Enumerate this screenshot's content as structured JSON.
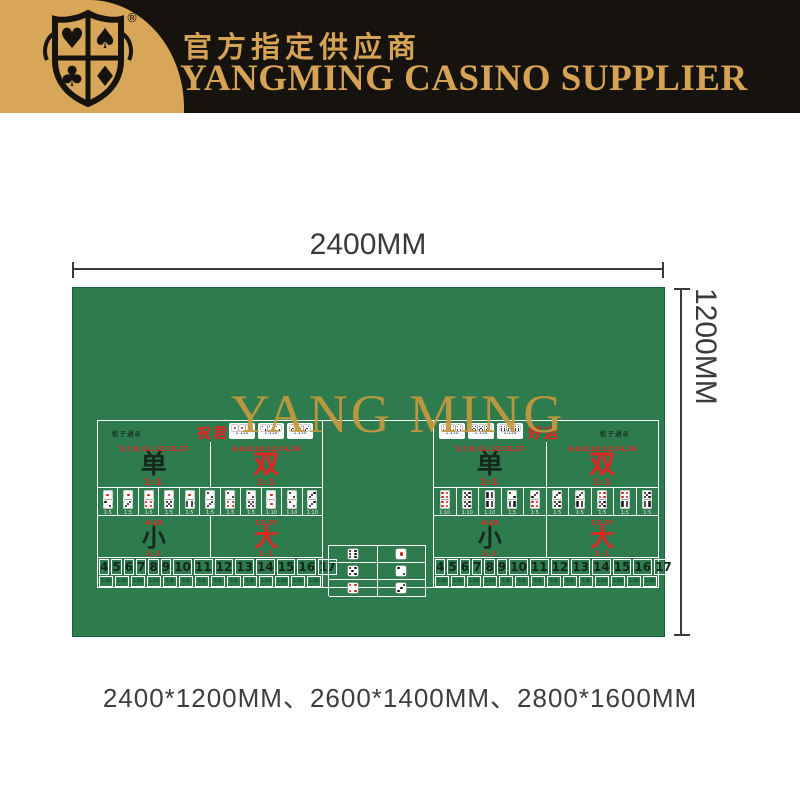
{
  "header": {
    "subtitle_cn": "官方指定供应商",
    "title_en": "YANGMING CASINO SUPPLIER",
    "badge": {
      "suits": [
        "heart",
        "spade",
        "club",
        "diamond"
      ],
      "suits_glyphs": [
        "♥",
        "♠",
        "♣",
        "♦"
      ],
      "registered_mark": "®"
    },
    "colors": {
      "gold": "#D8A658",
      "black": "#16130F"
    }
  },
  "dimensions": {
    "width_label": "2400MM",
    "height_label": "1200MM"
  },
  "table": {
    "felt_color": "#2E7B4E",
    "line_color": "#FFFFFF",
    "watermark": "YANG MING",
    "watermark_color": "#C49A3F",
    "accent_red": "#E42222",
    "center_singles": {
      "rows": [
        [
          6,
          1
        ],
        [
          5,
          2
        ],
        [
          4,
          3
        ]
      ]
    },
    "halves": [
      {
        "side": "left",
        "corner_note": "骰子通杀",
        "luck_label": "祝君",
        "triples": [
          {
            "die": 1,
            "odds": "1:150"
          },
          {
            "die": 2,
            "odds": "1:150"
          },
          {
            "die": 3,
            "odds": "1:150"
          }
        ],
        "odd_even": [
          {
            "numbers": "5,7,9,11,13,15,17",
            "char": "单",
            "odds": "1:1",
            "color": "dark"
          },
          {
            "numbers": "4,6,8,10,12,14,16",
            "char": "双",
            "odds": "1:1",
            "color": "red"
          }
        ],
        "pairs": [
          {
            "dice": [
              1,
              2
            ],
            "odds": "1:5"
          },
          {
            "dice": [
              1,
              3
            ],
            "odds": "1:5"
          },
          {
            "dice": [
              1,
              4
            ],
            "odds": "1:5"
          },
          {
            "dice": [
              1,
              5
            ],
            "odds": "1:5"
          },
          {
            "dice": [
              1,
              6
            ],
            "odds": "1:5"
          },
          {
            "dice": [
              2,
              3
            ],
            "odds": "1:5"
          },
          {
            "dice": [
              2,
              4
            ],
            "odds": "1:5"
          },
          {
            "dice": [
              2,
              5
            ],
            "odds": "1:5"
          },
          {
            "dice": [
              1,
              1
            ],
            "odds": "1:10"
          },
          {
            "dice": [
              2,
              2
            ],
            "odds": "1:10"
          },
          {
            "dice": [
              3,
              3
            ],
            "odds": "1:10"
          }
        ],
        "small_big": [
          {
            "range": "4-10",
            "char": "小",
            "odds": "1-1",
            "color": "dark"
          },
          {
            "range": "11-17",
            "char": "大",
            "odds": "1-1",
            "color": "red"
          }
        ],
        "totals": {
          "numbers": [
            "4",
            "5",
            "6",
            "7",
            "8",
            "9",
            "10",
            "11",
            "12",
            "13",
            "14",
            "15",
            "16",
            "17"
          ],
          "odds": [
            "1:50",
            "1:25",
            "1:18",
            "1:12",
            "1:8",
            "1:6",
            "1:6",
            "1:6",
            "1:6",
            "1:8",
            "1:12",
            "1:18",
            "1:25",
            "1:50"
          ]
        }
      },
      {
        "side": "right",
        "corner_note": "骰子通杀",
        "luck_label": "好运",
        "triples": [
          {
            "die": 4,
            "odds": "1:150"
          },
          {
            "die": 5,
            "odds": "1:150"
          },
          {
            "die": 6,
            "odds": "1:150"
          }
        ],
        "odd_even": [
          {
            "numbers": "5,7,9,11,13,15,17",
            "char": "单",
            "odds": "1:1",
            "color": "dark"
          },
          {
            "numbers": "4,6,8,10,12,14,16",
            "char": "双",
            "odds": "1:1",
            "color": "red"
          }
        ],
        "pairs": [
          {
            "dice": [
              4,
              4
            ],
            "odds": "1:10"
          },
          {
            "dice": [
              5,
              5
            ],
            "odds": "1:10"
          },
          {
            "dice": [
              6,
              6
            ],
            "odds": "1:10"
          },
          {
            "dice": [
              2,
              6
            ],
            "odds": "1:5"
          },
          {
            "dice": [
              3,
              4
            ],
            "odds": "1:5"
          },
          {
            "dice": [
              3,
              5
            ],
            "odds": "1:5"
          },
          {
            "dice": [
              3,
              6
            ],
            "odds": "1:5"
          },
          {
            "dice": [
              4,
              5
            ],
            "odds": "1:5"
          },
          {
            "dice": [
              4,
              6
            ],
            "odds": "1:5"
          },
          {
            "dice": [
              5,
              6
            ],
            "odds": "1:5"
          }
        ],
        "small_big": [
          {
            "range": "4-10",
            "char": "小",
            "odds": "1-1",
            "color": "dark"
          },
          {
            "range": "11-17",
            "char": "大",
            "odds": "1-1",
            "color": "red"
          }
        ],
        "totals": {
          "numbers": [
            "4",
            "5",
            "6",
            "7",
            "8",
            "9",
            "10",
            "11",
            "12",
            "13",
            "14",
            "15",
            "16",
            "17"
          ],
          "odds": [
            "1:50",
            "1:25",
            "1:18",
            "1:12",
            "1:8",
            "1:6",
            "1:6",
            "1:6",
            "1:6",
            "1:8",
            "1:12",
            "1:18",
            "1:25",
            "1:50"
          ]
        }
      }
    ]
  },
  "sizes_caption": "2400*1200MM、2600*1400MM、2800*1600MM"
}
